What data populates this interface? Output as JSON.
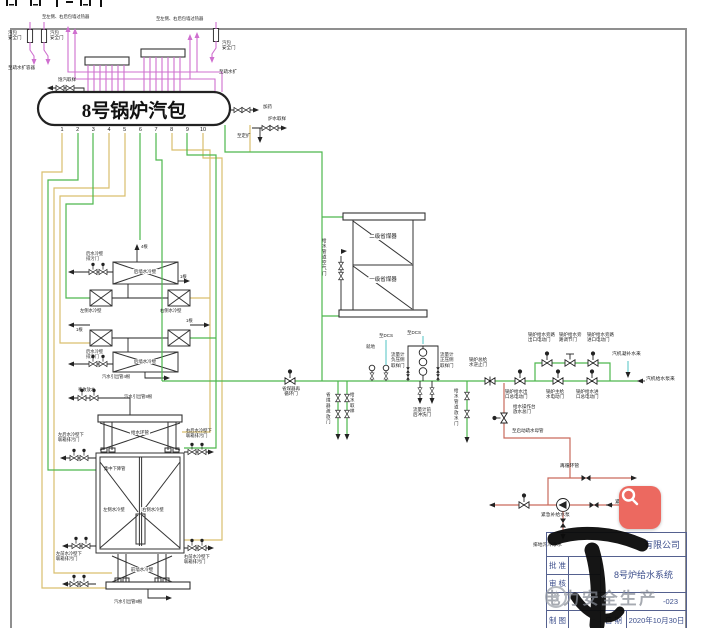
{
  "palette": {
    "pipe_magenta": "#cf6fcf",
    "pipe_green": "#4db84d",
    "pipe_yellow": "#d9bf6d",
    "pipe_cyan": "#5fc8c8",
    "pipe_red": "#c96a5c",
    "line_black": "#222222",
    "frame_gray": "#8f8f8f",
    "titleblock_text": "#3d4f8c",
    "watermark_gray": "#858a94",
    "button_red": "#ec6960"
  },
  "drum": {
    "title": "8号锅炉汽包",
    "outlet_numbers": [
      "1",
      "2",
      "3",
      "4",
      "5",
      "6",
      "7",
      "8",
      "9",
      "10"
    ]
  },
  "labels": [
    {
      "n": "to-superheater-left",
      "t": "至左侧、右后包墙过热器",
      "x": 42,
      "y": 14,
      "fs": 4.3
    },
    {
      "n": "to-superheater-right",
      "t": "至左侧、右后包墙过热器",
      "x": 156,
      "y": 16,
      "fs": 4.3
    },
    {
      "n": "drum-safety-valve-left-1",
      "t": "汽包\n安全门",
      "x": 8,
      "y": 30,
      "fs": 4.5
    },
    {
      "n": "drum-safety-valve-left-2",
      "t": "汽包\n安全门",
      "x": 50,
      "y": 30,
      "fs": 4.5
    },
    {
      "n": "drum-safety-valve-right",
      "t": "汽包\n安全门",
      "x": 222,
      "y": 40,
      "fs": 4.5
    },
    {
      "n": "to-drain-flash-tank",
      "t": "至疏水扩容器",
      "x": 8,
      "y": 65,
      "fs": 4.5
    },
    {
      "n": "to-drain-flash",
      "t": "至疏水扩",
      "x": 219,
      "y": 69,
      "fs": 4.5
    },
    {
      "n": "saturated-steam-sampling",
      "t": "饱汽取样",
      "x": 58,
      "y": 77,
      "fs": 4.5
    },
    {
      "n": "dosing",
      "t": "加药",
      "x": 263,
      "y": 104,
      "fs": 4.5
    },
    {
      "n": "boiler-water-sampling",
      "t": "炉水取样",
      "x": 268,
      "y": 116,
      "fs": 4.5
    },
    {
      "n": "to-periodic-blowdown-expander",
      "t": "至定扩",
      "x": 237,
      "y": 133,
      "fs": 4.5
    },
    {
      "n": "economizer-secondary",
      "t": "二级省煤器",
      "x": 383,
      "y": 234,
      "fs": 5.5,
      "ta": "c",
      "bg": 1
    },
    {
      "n": "economizer-primary",
      "t": "一级省煤器",
      "x": 383,
      "y": 277,
      "fs": 5.5,
      "ta": "c",
      "bg": 1
    },
    {
      "n": "fw-pipe-air-valve",
      "t": "给水管道空气门",
      "x": 322,
      "y": 238,
      "v": 1,
      "fs": 4.5
    },
    {
      "n": "economizer-recirc-valve",
      "t": "省煤器再\n循环门",
      "x": 291,
      "y": 386,
      "fs": 4.5,
      "ta": "c"
    },
    {
      "n": "economizer-drain-valve",
      "t": "省煤器疏放门",
      "x": 326,
      "y": 392,
      "v": 1,
      "fs": 4.5
    },
    {
      "n": "fw-sampling",
      "t": "给水取样",
      "x": 350,
      "y": 392,
      "v": 1,
      "fs": 4.5
    },
    {
      "n": "local-gauge",
      "t": "就地",
      "x": 366,
      "y": 344,
      "fs": 4.5
    },
    {
      "n": "to-dcs-1",
      "t": "至DCS",
      "x": 379,
      "y": 333,
      "fs": 4.5
    },
    {
      "n": "to-dcs-2",
      "t": "至DCS",
      "x": 407,
      "y": 330,
      "fs": 4.5
    },
    {
      "n": "flowmeter-neg-sampling",
      "t": "流量计\n负压侧\n取样门",
      "x": 391,
      "y": 352,
      "fs": 4.5
    },
    {
      "n": "flowmeter-pos-sampling",
      "t": "流量计\n正压侧\n取样门",
      "x": 440,
      "y": 352,
      "fs": 4.5
    },
    {
      "n": "flowmeter-flush-valve",
      "t": "流量计前\n后冲洗门",
      "x": 413,
      "y": 407,
      "fs": 4.5
    },
    {
      "n": "fw-pipe-drain-valve",
      "t": "给水管道放水门",
      "x": 454,
      "y": 388,
      "v": 1,
      "fs": 4.5
    },
    {
      "n": "main-check-valve",
      "t": "锅炉总给\n水逆止门",
      "x": 469,
      "y": 357,
      "fs": 4.5
    },
    {
      "n": "outlet-main-motor-valve",
      "t": "锅炉给水出\n口总电动门",
      "x": 505,
      "y": 389,
      "fs": 4.5
    },
    {
      "n": "bypass-outlet-valve",
      "t": "锅炉给水旁路\n出口电动门",
      "x": 528,
      "y": 332,
      "fs": 4.5
    },
    {
      "n": "bypass-reg-valve",
      "t": "锅炉给水旁\n路调节门",
      "x": 559,
      "y": 332,
      "fs": 4.5
    },
    {
      "n": "bypass-inlet-valve",
      "t": "锅炉给水旁路\n进口电动门",
      "x": 587,
      "y": 332,
      "fs": 4.5
    },
    {
      "n": "main-fw-motor-valve",
      "t": "锅炉主给\n水电动门",
      "x": 546,
      "y": 389,
      "fs": 4.5
    },
    {
      "n": "inlet-main-motor-valve",
      "t": "锅炉给水进\n口总电动门",
      "x": 576,
      "y": 389,
      "fs": 4.5
    },
    {
      "n": "turbine-condensate-makeup",
      "t": "汽机凝补水来",
      "x": 612,
      "y": 352,
      "fs": 4.8
    },
    {
      "n": "from-turbine-fw-pump",
      "t": "汽机给水泵来",
      "x": 646,
      "y": 377,
      "fs": 4.8
    },
    {
      "n": "platform-drain-valve",
      "t": "给水操作台\n放水总门",
      "x": 513,
      "y": 404,
      "fs": 4.5
    },
    {
      "n": "to-startup-drain-header",
      "t": "至启动疏水母管",
      "x": 512,
      "y": 428,
      "fs": 4.5
    },
    {
      "n": "recirc-pipe",
      "t": "再循环管",
      "x": 560,
      "y": 464,
      "fs": 4.8
    },
    {
      "n": "emergency-makeup-pump",
      "t": "紧急补给水泵",
      "x": 541,
      "y": 513,
      "fs": 4.8
    },
    {
      "n": "from-emergency-tank",
      "t": "紧急补给水箱来",
      "x": 615,
      "y": 500,
      "fs": 4.8
    },
    {
      "n": "drain-to-trench",
      "t": "排地沟冷净水",
      "x": 533,
      "y": 543,
      "fs": 4.8
    },
    {
      "n": "rear-ww-blowdown-upper",
      "t": "后水冷壁\n排污门",
      "x": 86,
      "y": 251,
      "fs": 4.3
    },
    {
      "n": "tube-count-4",
      "t": "4根",
      "x": 141,
      "y": 244,
      "fs": 4.3
    },
    {
      "n": "tube-count-1a",
      "t": "1根",
      "x": 180,
      "y": 274,
      "fs": 4.3
    },
    {
      "n": "tube-count-1b",
      "t": "1根",
      "x": 76,
      "y": 327,
      "fs": 4.3
    },
    {
      "n": "tube-count-1c",
      "t": "1根",
      "x": 186,
      "y": 318,
      "fs": 4.3
    },
    {
      "n": "rear-wall-ww-upper",
      "t": "后墙水冷壁",
      "x": 145,
      "y": 269,
      "fs": 4.5,
      "ta": "c",
      "bg": 1
    },
    {
      "n": "left-side-ww",
      "t": "左侧水冷壁",
      "x": 80,
      "y": 308,
      "fs": 4.3
    },
    {
      "n": "right-side-ww",
      "t": "右侧水冷壁",
      "x": 160,
      "y": 308,
      "fs": 4.3
    },
    {
      "n": "rear-ww-blowdown-lower",
      "t": "后水冷壁\n排污门",
      "x": 86,
      "y": 349,
      "fs": 4.3
    },
    {
      "n": "rear-wall-ww-lower",
      "t": "后墙水冷壁",
      "x": 145,
      "y": 359,
      "fs": 4.5,
      "ta": "c",
      "bg": 1
    },
    {
      "n": "outlet-pipes-4",
      "t": "汽水引出管4根",
      "x": 102,
      "y": 374,
      "fs": 4.3
    },
    {
      "n": "accident-drain",
      "t": "事故放水",
      "x": 78,
      "y": 387,
      "fs": 4.3
    },
    {
      "n": "outlet-pipes-8a",
      "t": "汽水引出管8根",
      "x": 124,
      "y": 394,
      "fs": 4.3
    },
    {
      "n": "fw-ring-header",
      "t": "给水环管",
      "x": 140,
      "y": 430,
      "fs": 4.5,
      "ta": "c",
      "bg": 1
    },
    {
      "n": "central-downcomer",
      "t": "集中下降管",
      "x": 104,
      "y": 466,
      "fs": 4.3
    },
    {
      "n": "lr-ww-header-blowdown",
      "t": "左后水冷壁下\n联箱排污门",
      "x": 58,
      "y": 432,
      "fs": 4.3
    },
    {
      "n": "rr-ww-header-blowdown",
      "t": "右后水冷壁下\n联箱排污门",
      "x": 186,
      "y": 428,
      "fs": 4.3
    },
    {
      "n": "box-left-ww",
      "t": "左侧水冷壁",
      "x": 114,
      "y": 507,
      "fs": 4.3,
      "ta": "c",
      "bg": 1
    },
    {
      "n": "box-right-ww",
      "t": "右侧水冷壁",
      "x": 153,
      "y": 507,
      "fs": 4.3,
      "ta": "c",
      "bg": 1
    },
    {
      "n": "lf-ww-header-blowdown",
      "t": "左前水冷壁下\n联箱排污门",
      "x": 56,
      "y": 551,
      "fs": 4.3
    },
    {
      "n": "rf-ww-header-blowdown",
      "t": "右前水冷壁下\n联箱排污门",
      "x": 184,
      "y": 554,
      "fs": 4.3
    },
    {
      "n": "front-wall-ww",
      "t": "前墙水冷壁",
      "x": 142,
      "y": 567,
      "fs": 4.5,
      "ta": "c",
      "bg": 1
    },
    {
      "n": "outlet-pipes-8b",
      "t": "汽水引出管8根",
      "x": 114,
      "y": 599,
      "fs": 4.3
    }
  ],
  "title_block": {
    "company_suffix": "有限公司",
    "approved_label": "批 准",
    "reviewed_label": "审 核",
    "drawn_label": "制 图",
    "drawing_title": "8号炉给水系统",
    "drawing_no_suffix": "-023",
    "date_label": "日 期",
    "date_value": "2020年10月30日"
  },
  "watermark": {
    "text": "电力安全生产"
  },
  "search_button": {
    "icon": "magnifier-icon"
  }
}
